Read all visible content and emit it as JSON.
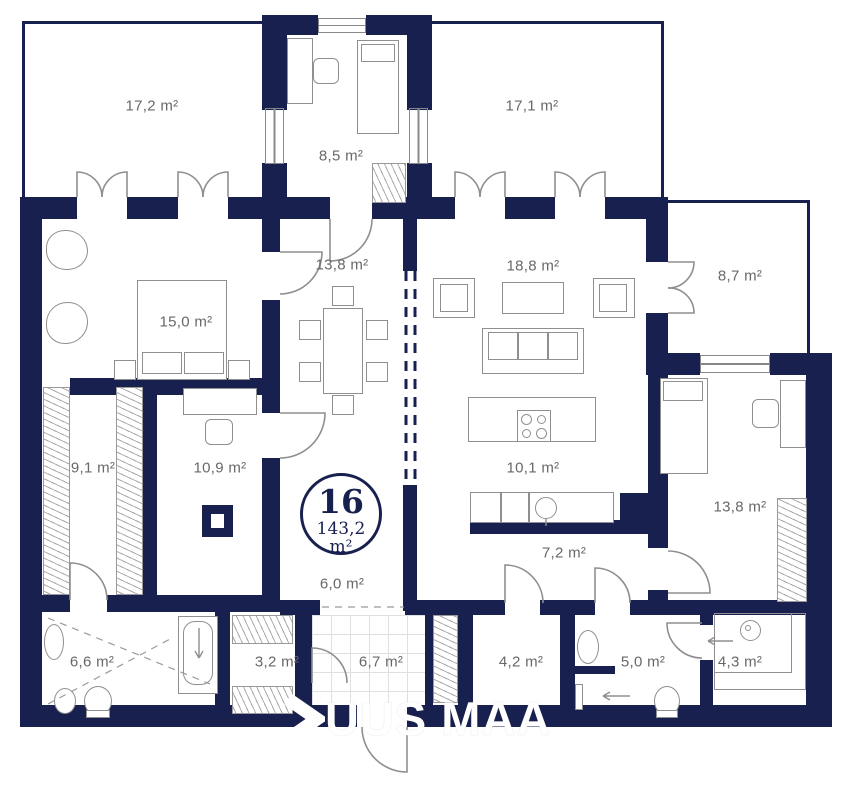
{
  "floorplan": {
    "unit_number": "16",
    "total_area": "143,2 m²",
    "watermark": "UUS MAA",
    "colors": {
      "wall": "#18204f",
      "label_text": "#686868",
      "furniture_line": "#8f8f8f",
      "watermark": "#ffffff"
    },
    "rooms": [
      {
        "name": "terrace-top-left",
        "label": "17,2 m²"
      },
      {
        "name": "room-top",
        "label": "8,5 m²"
      },
      {
        "name": "terrace-top-right",
        "label": "17,1 m²"
      },
      {
        "name": "terrace-right",
        "label": "8,7 m²"
      },
      {
        "name": "bedroom",
        "label": "15,0 m²"
      },
      {
        "name": "dining-hall",
        "label": "13,8 m²"
      },
      {
        "name": "living-room",
        "label": "18,8 m²"
      },
      {
        "name": "dressing",
        "label": "9,1 m²"
      },
      {
        "name": "office",
        "label": "10,9 m²"
      },
      {
        "name": "kitchen",
        "label": "10,1 m²"
      },
      {
        "name": "bedroom-2",
        "label": "13,8 m²"
      },
      {
        "name": "hallway",
        "label": "7,2 m²"
      },
      {
        "name": "hall",
        "label": "6,0 m²"
      },
      {
        "name": "bathroom",
        "label": "6,6 m²"
      },
      {
        "name": "closet",
        "label": "3,2 m²"
      },
      {
        "name": "entry",
        "label": "6,7 m²"
      },
      {
        "name": "shower-room",
        "label": "4,2 m²"
      },
      {
        "name": "wc",
        "label": "5,0 m²"
      },
      {
        "name": "utility",
        "label": "4,3 m²"
      }
    ]
  }
}
